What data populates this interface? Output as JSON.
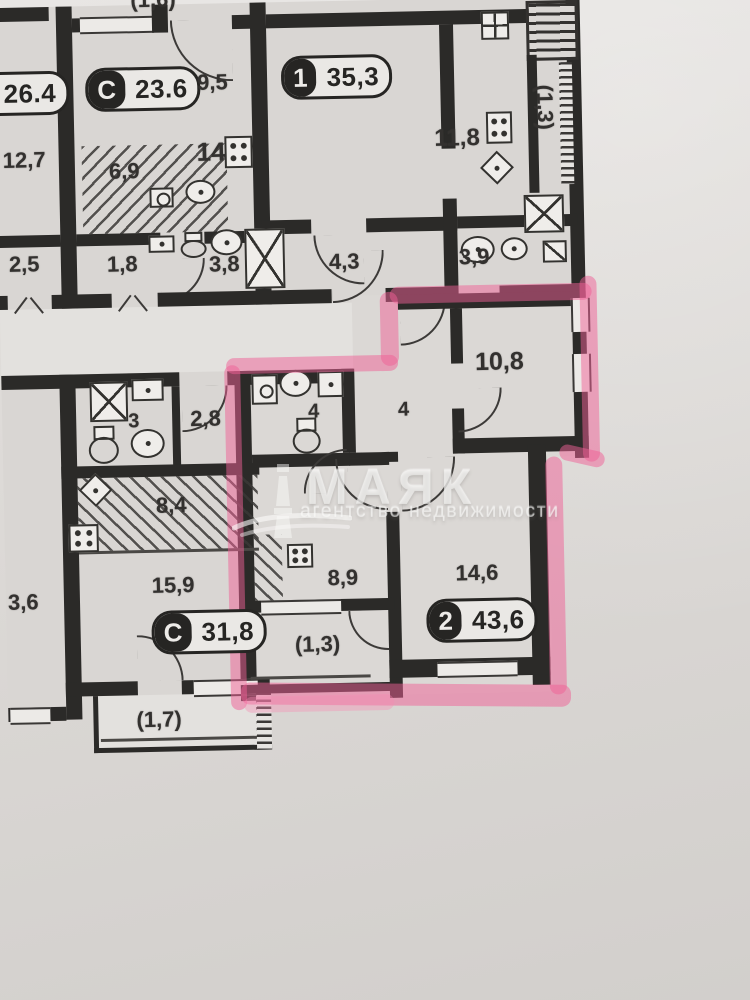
{
  "watermark": {
    "brand": "МАЯК",
    "tagline": "агентство недвижимости"
  },
  "badges": {
    "left_cut": {
      "area": "26.4"
    },
    "studio_top": {
      "type": "С",
      "area": "23.6"
    },
    "one_room": {
      "type": "1",
      "area": "35,3"
    },
    "studio_bottom": {
      "type": "С",
      "area": "31,8"
    },
    "two_room": {
      "type": "2",
      "area": "43,6"
    }
  },
  "labels": {
    "balcony_top": "(1,6)",
    "room_12_7": "12,7",
    "room_2_5": "2,5",
    "hall_9_5": "9,5",
    "kitchen_6_9": "6,9",
    "bath_1_8": "1,8",
    "bath_3_8": "3,8",
    "room_14": "14",
    "hall_4_3": "4,3",
    "kitchen_11_8": "11,8",
    "bath_3_9": "3,9",
    "balcony_right": "(1,3)",
    "room_10_8": "10,8",
    "hall_4": "4",
    "bath_4": "4",
    "bath_3": "3",
    "hall_2_8": "2,8",
    "kitchen_8_4": "8,4",
    "room_3_6": "3,6",
    "room_15_9": "15,9",
    "kitchen_8_9": "8,9",
    "room_14_6": "14,6",
    "balcony_pink": "(1,3)",
    "balcony_1_7": "(1,7)"
  },
  "highlight_color": "#f06096"
}
